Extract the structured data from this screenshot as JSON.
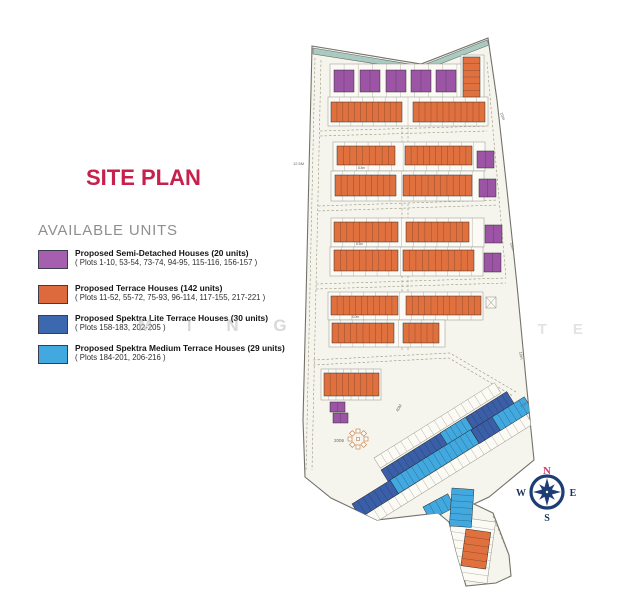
{
  "title": "SITE PLAN",
  "title_color": "#c7204d",
  "legend": {
    "heading": "AVAILABLE UNITS",
    "items": [
      {
        "color": "#a55fae",
        "title": "Proposed Semi-Detached Houses (20 units)",
        "plots": "( Plots 1-10, 53-54, 73-74, 94-95, 115-116, 156-157 )"
      },
      {
        "color": "#dd6a3c",
        "title": "Proposed Terrace Houses (142 units)",
        "plots": "( Plots 11-52, 55-72, 75-93, 96-114, 117-155, 217-221 )"
      },
      {
        "color": "#3c68b0",
        "title": "Proposed Spektra Lite Terrace Houses (30 units)",
        "plots": "( Plots 158-183, 202-205 )"
      },
      {
        "color": "#41a9e0",
        "title": "Proposed Spektra Medium Terrace Houses (29 units)",
        "plots": "( Plots 184-201, 206-216 )"
      }
    ]
  },
  "watermark": {
    "left": "M I N G W",
    "right": "S L I T E"
  },
  "compass": {
    "n": "N",
    "e": "E",
    "s": "S",
    "w": "W",
    "north_color": "#d63a6e",
    "rose_color": "#1d3e75"
  },
  "map": {
    "colors": {
      "semi": "#9c55a5",
      "terrace": "#e0713f",
      "lite": "#3a5fa8",
      "medium": "#41a9e0",
      "empty": "#fbfaf4"
    },
    "blocks": [
      {
        "x": 330,
        "y": 64,
        "w": 141,
        "h": 34,
        "f": "empty",
        "u": 10
      },
      {
        "x": 461,
        "y": 55,
        "w": 23,
        "h": 44,
        "f": "empty",
        "u": 0
      },
      {
        "x": 328,
        "y": 97,
        "w": 160,
        "h": 29,
        "f": "empty",
        "u": 14
      },
      {
        "x": 333,
        "y": 142,
        "w": 152,
        "h": 29,
        "f": "empty",
        "u": 13
      },
      {
        "x": 331,
        "y": 171,
        "w": 153,
        "h": 30,
        "f": "empty",
        "u": 13
      },
      {
        "x": 331,
        "y": 218,
        "w": 153,
        "h": 29,
        "f": "empty",
        "u": 13
      },
      {
        "x": 330,
        "y": 247,
        "w": 153,
        "h": 29,
        "f": "empty",
        "u": 13
      },
      {
        "x": 328,
        "y": 292,
        "w": 155,
        "h": 28,
        "f": "empty",
        "u": 13
      },
      {
        "x": 329,
        "y": 320,
        "w": 116,
        "h": 27,
        "f": "empty",
        "u": 10
      },
      {
        "x": 321,
        "y": 369,
        "w": 60,
        "h": 31,
        "f": "empty",
        "u": 8
      },
      {
        "x": 374,
        "y": 458,
        "w": 142,
        "h": 12,
        "f": "empty",
        "u": 18,
        "r": -32
      },
      {
        "x": 390,
        "y": 484,
        "w": 148,
        "h": 12,
        "f": "empty",
        "u": 19,
        "r": -32
      },
      {
        "x": 360,
        "y": 518,
        "w": 196,
        "h": 12,
        "f": "empty",
        "u": 24,
        "r": -32
      },
      {
        "x": 452,
        "y": 516,
        "w": 44,
        "h": 62,
        "f": "empty",
        "u": 8,
        "d": "h",
        "r": 8
      },
      {
        "x": 334,
        "y": 70,
        "w": 20,
        "h": 22,
        "f": "semi",
        "u": 2
      },
      {
        "x": 360,
        "y": 70,
        "w": 20,
        "h": 22,
        "f": "semi",
        "u": 2
      },
      {
        "x": 386,
        "y": 70,
        "w": 20,
        "h": 22,
        "f": "semi",
        "u": 2
      },
      {
        "x": 411,
        "y": 70,
        "w": 20,
        "h": 22,
        "f": "semi",
        "u": 2
      },
      {
        "x": 436,
        "y": 70,
        "w": 20,
        "h": 22,
        "f": "semi",
        "u": 2
      },
      {
        "x": 463,
        "y": 57,
        "w": 17,
        "h": 40,
        "f": "terrace",
        "u": 6,
        "d": "h"
      },
      {
        "x": 331,
        "y": 102,
        "w": 71,
        "h": 20,
        "f": "terrace",
        "u": 12
      },
      {
        "x": 413,
        "y": 102,
        "w": 72,
        "h": 20,
        "f": "terrace",
        "u": 12
      },
      {
        "x": 337,
        "y": 146,
        "w": 58,
        "h": 19,
        "f": "terrace",
        "u": 9
      },
      {
        "x": 405,
        "y": 146,
        "w": 67,
        "h": 19,
        "f": "terrace",
        "u": 11
      },
      {
        "x": 335,
        "y": 175,
        "w": 61,
        "h": 21,
        "f": "terrace",
        "u": 10
      },
      {
        "x": 403,
        "y": 175,
        "w": 69,
        "h": 21,
        "f": "terrace",
        "u": 11
      },
      {
        "x": 477,
        "y": 151,
        "w": 17,
        "h": 17,
        "f": "semi",
        "u": 2
      },
      {
        "x": 479,
        "y": 179,
        "w": 17,
        "h": 18,
        "f": "semi",
        "u": 2
      },
      {
        "x": 334,
        "y": 222,
        "w": 64,
        "h": 20,
        "f": "terrace",
        "u": 10
      },
      {
        "x": 406,
        "y": 222,
        "w": 63,
        "h": 20,
        "f": "terrace",
        "u": 10
      },
      {
        "x": 485,
        "y": 225,
        "w": 17,
        "h": 18,
        "f": "semi",
        "u": 2
      },
      {
        "x": 334,
        "y": 250,
        "w": 64,
        "h": 21,
        "f": "terrace",
        "u": 10
      },
      {
        "x": 403,
        "y": 250,
        "w": 71,
        "h": 21,
        "f": "terrace",
        "u": 11
      },
      {
        "x": 484,
        "y": 253,
        "w": 17,
        "h": 19,
        "f": "semi",
        "u": 2
      },
      {
        "x": 331,
        "y": 296,
        "w": 67,
        "h": 19,
        "f": "terrace",
        "u": 11
      },
      {
        "x": 406,
        "y": 296,
        "w": 75,
        "h": 19,
        "f": "terrace",
        "u": 12
      },
      {
        "x": 332,
        "y": 323,
        "w": 62,
        "h": 20,
        "f": "terrace",
        "u": 10
      },
      {
        "x": 403,
        "y": 323,
        "w": 36,
        "h": 20,
        "f": "terrace",
        "u": 6
      },
      {
        "x": 324,
        "y": 373,
        "w": 55,
        "h": 23,
        "f": "terrace",
        "u": 9
      },
      {
        "x": 330,
        "y": 402,
        "w": 15,
        "h": 10,
        "f": "semi",
        "u": 2
      },
      {
        "x": 333,
        "y": 413,
        "w": 15,
        "h": 10,
        "f": "semi",
        "u": 2
      },
      {
        "x": 381,
        "y": 470,
        "w": 70,
        "h": 16,
        "f": "lite",
        "u": 11,
        "r": -32
      },
      {
        "x": 440,
        "y": 433,
        "w": 30,
        "h": 16,
        "f": "medium",
        "u": 5,
        "r": -32
      },
      {
        "x": 466,
        "y": 417,
        "w": 48,
        "h": 16,
        "f": "lite",
        "u": 8,
        "r": -32
      },
      {
        "x": 352,
        "y": 504,
        "w": 45,
        "h": 16,
        "f": "lite",
        "u": 7,
        "r": -32
      },
      {
        "x": 390,
        "y": 480,
        "w": 95,
        "h": 16,
        "f": "medium",
        "u": 15,
        "r": -32
      },
      {
        "x": 471,
        "y": 430,
        "w": 25,
        "h": 16,
        "f": "lite",
        "u": 4,
        "r": -32
      },
      {
        "x": 492,
        "y": 417,
        "w": 38,
        "h": 16,
        "f": "medium",
        "u": 6,
        "r": -32
      },
      {
        "x": 423,
        "y": 507,
        "w": 28,
        "h": 15,
        "f": "medium",
        "u": 4,
        "r": -28
      },
      {
        "x": 452,
        "y": 488,
        "w": 22,
        "h": 38,
        "f": "medium",
        "u": 6,
        "d": "h",
        "r": 4
      },
      {
        "x": 466,
        "y": 529,
        "w": 25,
        "h": 37,
        "f": "terrace",
        "u": 5,
        "d": "h",
        "r": 8
      }
    ],
    "labels": [
      {
        "t": "12.5M",
        "x": 293,
        "y": 165,
        "r": 0,
        "s": 4
      },
      {
        "t": "10m",
        "x": 500,
        "y": 113,
        "r": 68,
        "s": 4
      },
      {
        "t": "10m",
        "x": 510,
        "y": 243,
        "r": 75,
        "s": 4
      },
      {
        "t": "10m",
        "x": 519,
        "y": 352,
        "r": 78,
        "s": 4
      },
      {
        "t": "40M",
        "x": 398,
        "y": 412,
        "r": -60,
        "s": 4
      },
      {
        "t": "7.0m",
        "x": 521,
        "y": 408,
        "r": -35,
        "s": 3.5
      },
      {
        "t": "2006",
        "x": 334,
        "y": 442,
        "r": 0,
        "s": 4.5
      },
      {
        "t": "8.5m",
        "x": 358,
        "y": 169,
        "r": 0,
        "s": 3.2
      },
      {
        "t": "8.5m",
        "x": 356,
        "y": 245,
        "r": 0,
        "s": 3.2
      },
      {
        "t": "6.0m",
        "x": 352,
        "y": 318,
        "r": 0,
        "s": 3.2
      }
    ]
  }
}
